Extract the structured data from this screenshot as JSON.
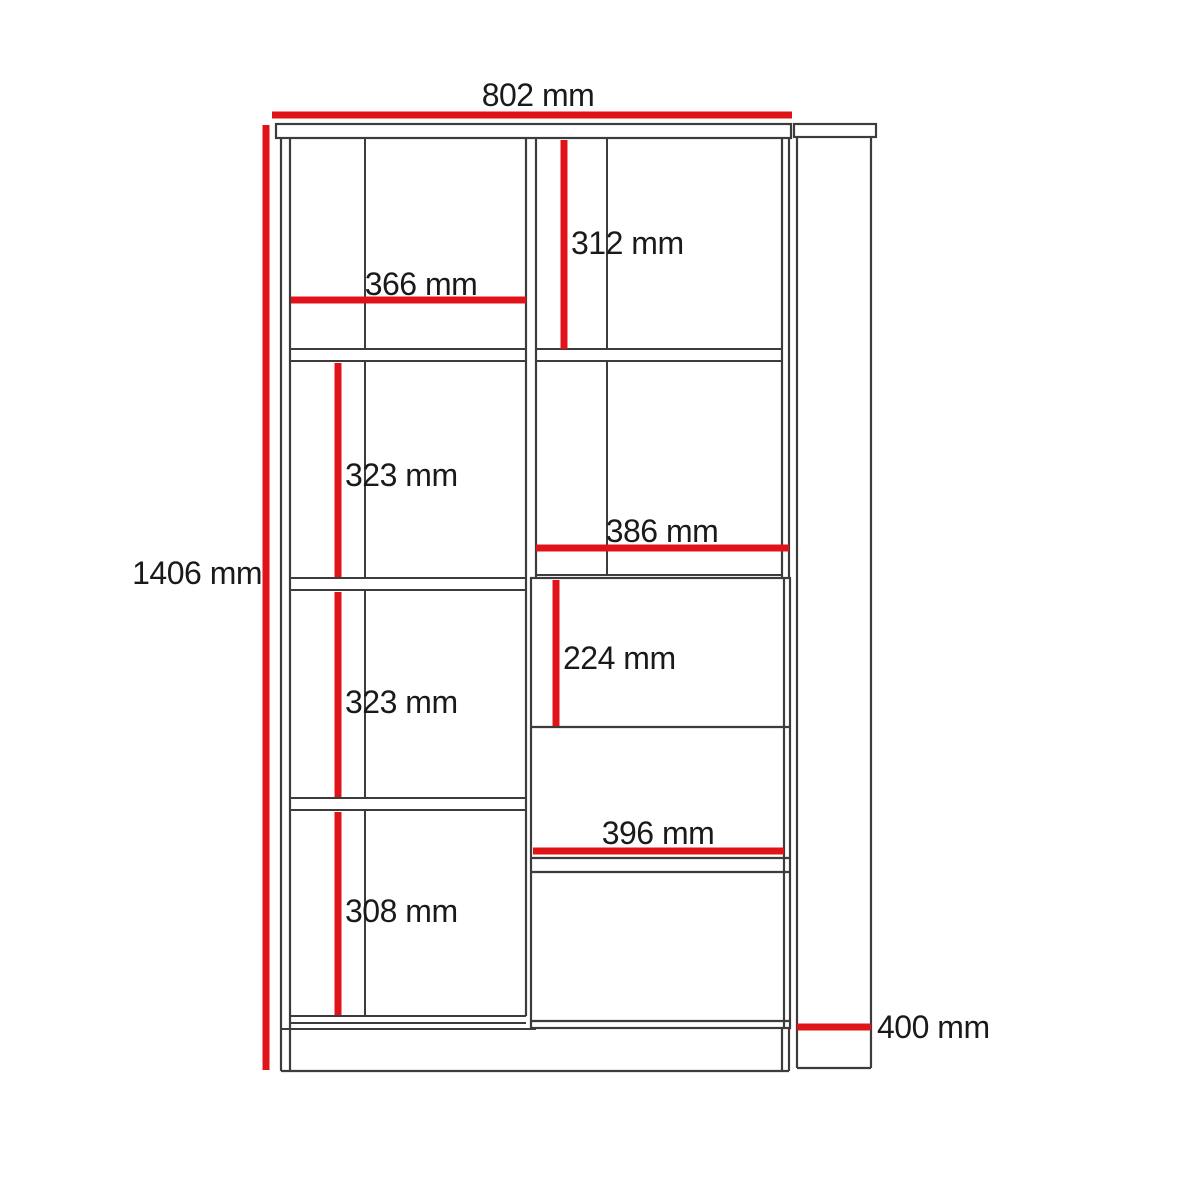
{
  "diagram": {
    "type": "furniture-technical-drawing",
    "subject": "bookcase with shelves, flap and drawers — front elevation and side elevation",
    "unit": "mm",
    "views": {
      "front": "front-elevation",
      "side": "side-elevation"
    }
  },
  "colors": {
    "background": "#ffffff",
    "outline": "#3c3c3c",
    "dimension_line": "#e01418",
    "text": "#1a1a1a"
  },
  "dimensions": [
    {
      "id": "overall-width",
      "label": "802 mm",
      "value": 802,
      "unit": "mm",
      "orientation": "horizontal"
    },
    {
      "id": "overall-height",
      "label": "1406 mm",
      "value": 1406,
      "unit": "mm",
      "orientation": "vertical"
    },
    {
      "id": "left-compartment-width",
      "label": "366 mm",
      "value": 366,
      "unit": "mm",
      "orientation": "horizontal"
    },
    {
      "id": "right-top-compartment-height",
      "label": "312 mm",
      "value": 312,
      "unit": "mm",
      "orientation": "vertical"
    },
    {
      "id": "left-upper-compartment-height",
      "label": "323 mm",
      "value": 323,
      "unit": "mm",
      "orientation": "vertical"
    },
    {
      "id": "right-compartment-width",
      "label": "386 mm",
      "value": 386,
      "unit": "mm",
      "orientation": "horizontal"
    },
    {
      "id": "flap-front-height",
      "label": "224 mm",
      "value": 224,
      "unit": "mm",
      "orientation": "vertical"
    },
    {
      "id": "left-middle-compartment-height",
      "label": "323 mm",
      "value": 323,
      "unit": "mm",
      "orientation": "vertical"
    },
    {
      "id": "drawer-front-width",
      "label": "396 mm",
      "value": 396,
      "unit": "mm",
      "orientation": "horizontal"
    },
    {
      "id": "left-bottom-compartment-height",
      "label": "308 mm",
      "value": 308,
      "unit": "mm",
      "orientation": "vertical"
    },
    {
      "id": "depth",
      "label": "400 mm",
      "value": 400,
      "unit": "mm",
      "orientation": "horizontal"
    }
  ]
}
